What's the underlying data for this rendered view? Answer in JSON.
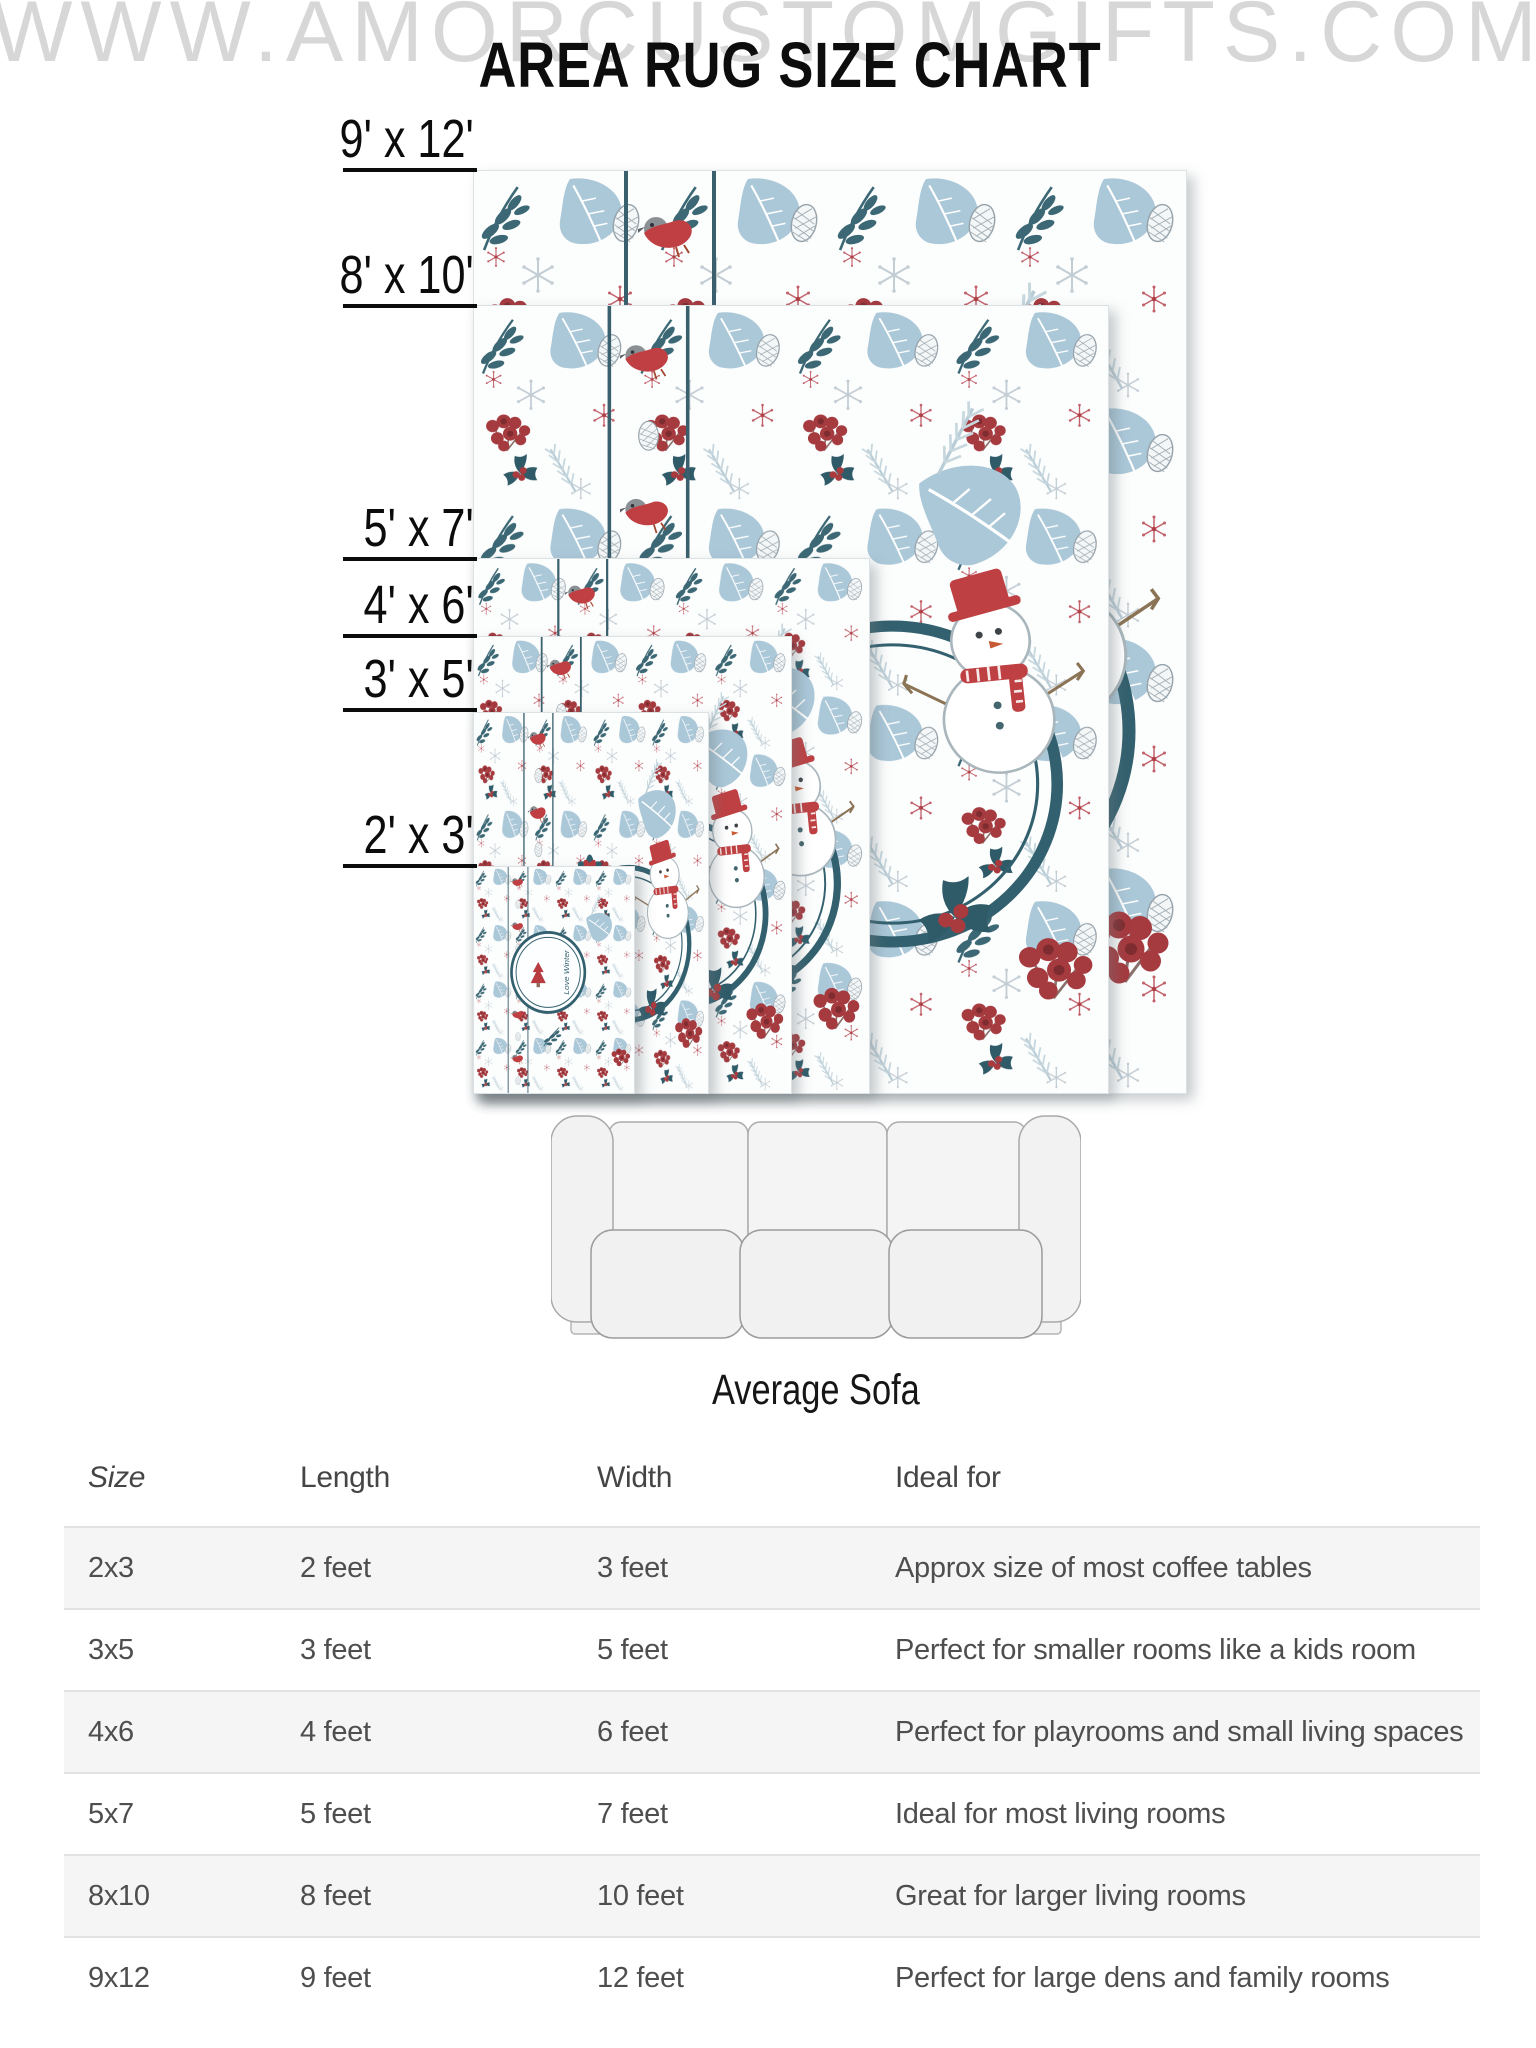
{
  "watermark": "WWW.AMORCUSTOMGIFTS.COM",
  "title": "AREA RUG SIZE CHART",
  "rug_area": {
    "badge_text": "Love Winter",
    "sizes": [
      {
        "id": "9x12",
        "label": "9' x 12'"
      },
      {
        "id": "8x10",
        "label": "8' x 10'"
      },
      {
        "id": "5x7",
        "label": "5' x 7'"
      },
      {
        "id": "4x6",
        "label": "4' x 6'"
      },
      {
        "id": "3x5",
        "label": "3' x 5'"
      },
      {
        "id": "2x3",
        "label": "2' x 3'"
      }
    ]
  },
  "sofa": {
    "caption": "Average Sofa"
  },
  "size_table": {
    "headers": [
      "Size",
      "Length",
      "Width",
      "Ideal for"
    ],
    "rows": [
      {
        "size": "2x3",
        "length": "2 feet",
        "width": "3 feet",
        "ideal": "Approx size of most coffee tables"
      },
      {
        "size": "3x5",
        "length": "3 feet",
        "width": "5 feet",
        "ideal": "Perfect for smaller rooms like a kids room"
      },
      {
        "size": "4x6",
        "length": "4 feet",
        "width": "6 feet",
        "ideal": "Perfect for playrooms and small living spaces"
      },
      {
        "size": "5x7",
        "length": "5 feet",
        "width": "7 feet",
        "ideal": "Ideal for most living rooms"
      },
      {
        "size": "8x10",
        "length": "8 feet",
        "width": "10 feet",
        "ideal": "Great for larger living rooms"
      },
      {
        "size": "9x12",
        "length": "9 feet",
        "width": "12 feet",
        "ideal": "Perfect for large dens and family rooms"
      }
    ]
  },
  "colors": {
    "watermark_gray": "#d7d7d7",
    "title_black": "#0d0d0d",
    "label_black": "#0c0c0c",
    "table_text_gray": "#4e4e4e",
    "band_gray": "#f5f5f6",
    "line_gray": "#e2e2e2",
    "rug_teal": "#3a5f6d",
    "rug_red": "#b73b40",
    "berry_red": "#a53a3f",
    "leaf_blue": "#abc8d9",
    "flake_blue": "#c3cdd4"
  }
}
